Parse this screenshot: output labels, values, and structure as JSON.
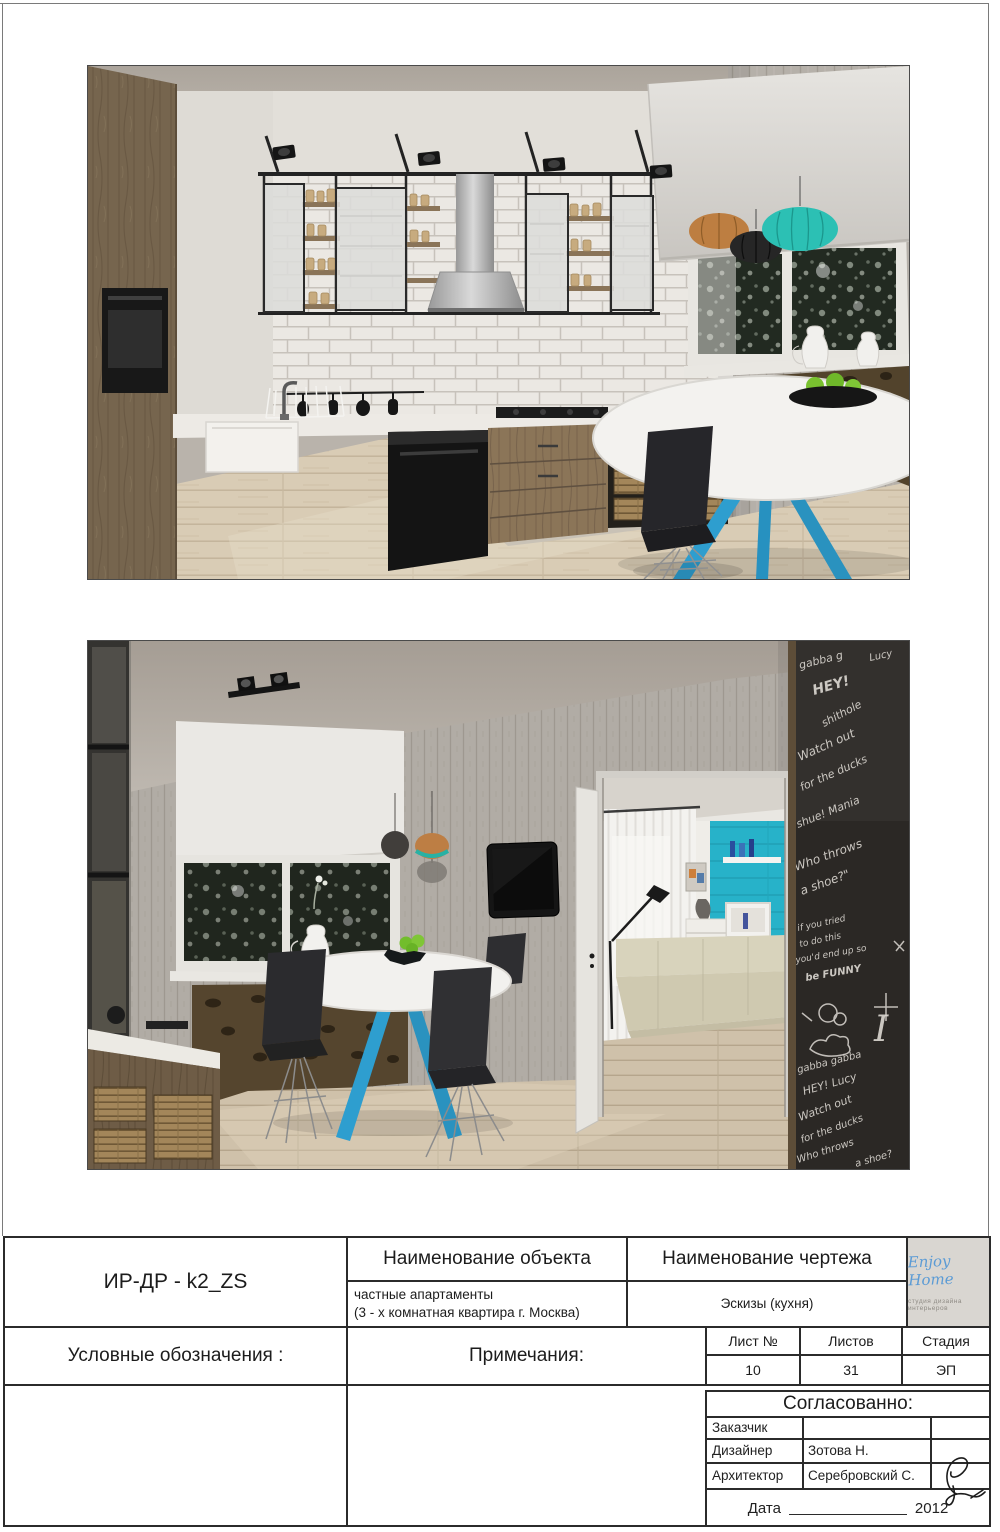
{
  "title_block": {
    "doc_code": "ИР-ДР - k2_ZS",
    "object_header": "Наименование объекта",
    "object_line1": "частные апартаменты",
    "object_line2": "(3 - х комнатная квартира г. Москва)",
    "drawing_header": "Наименование чертежа",
    "drawing_value": "Эскизы (кухня)",
    "legend_label": "Условные обозначения :",
    "notes_label": "Примечания:",
    "sheet_no_header": "Лист №",
    "sheet_no_value": "10",
    "sheets_total_header": "Листов",
    "sheets_total_value": "31",
    "stage_header": "Стадия",
    "stage_value": "ЭП",
    "approved_header": "Согласованно:",
    "client_label": "Заказчик",
    "client_value": "",
    "designer_label": "Дизайнер",
    "designer_value": "Зотова Н.",
    "architect_label": "Архитектор",
    "architect_value": "Серебровский С.",
    "date_label": "Дата",
    "date_year": "2012"
  },
  "logo": {
    "name": "Enjoy Home",
    "tagline": "студия дизайна интерьеров",
    "accent": "#5b9bd5"
  },
  "palette": {
    "table_leg_blue": "#2e9ecf",
    "pendant_teal": "#2cc0b4",
    "pendant_orange": "#bd7e41",
    "accent_wall_turquoise": "#27b2c9",
    "apple_green": "#79c12f",
    "chalkboard": "#2b2825",
    "cabinet_wood": "#76654e",
    "floor_wood": "#d9ccb5"
  },
  "render2": {
    "chalkboard": {
      "phrases": [
        "gabba g",
        "Lucy",
        "HEY!",
        "shithole",
        "Watch out",
        "for the ducks",
        "shue! Mania",
        "Who throws",
        "a shoe?\"",
        "if you tried",
        "to do this",
        "you'd end up so",
        "be FUNNY",
        "I",
        "gabba gabba",
        "HEY! Lucy",
        "Watch out",
        "for the ducks",
        "Who throws",
        "a shoe?"
      ]
    }
  }
}
